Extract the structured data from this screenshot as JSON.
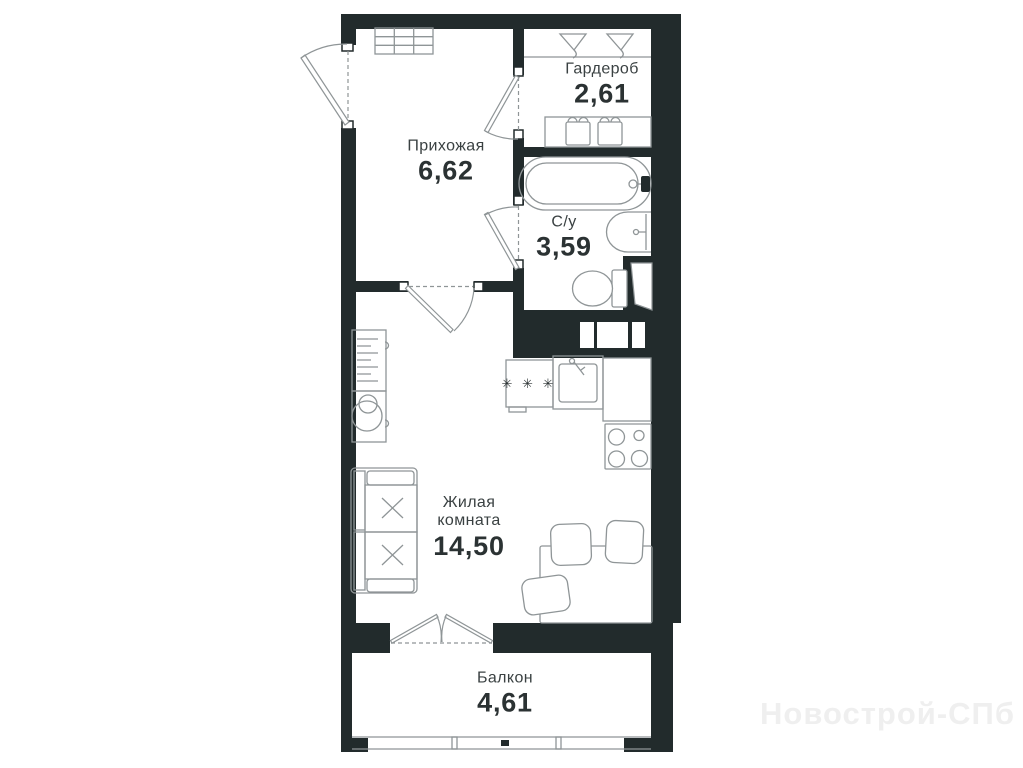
{
  "plan": {
    "watermark": "Новострой-СПб",
    "colors": {
      "wall": "#222b2c",
      "furniture_line": "#8f9597",
      "text": "#2b3233",
      "watermark": "#efefef"
    },
    "rooms": {
      "hallway": {
        "name": "Прихожая",
        "area": "6,62"
      },
      "wardrobe": {
        "name": "Гардероб",
        "area": "2,61"
      },
      "bathroom": {
        "name": "С/у",
        "area": "3,59"
      },
      "living_room": {
        "name": "Жилая комната",
        "area": "14,50"
      },
      "balcony": {
        "name": "Балкон",
        "area": "4,61"
      }
    },
    "kitchen": {
      "hob_marker": "✳ ✳ ✳"
    }
  }
}
